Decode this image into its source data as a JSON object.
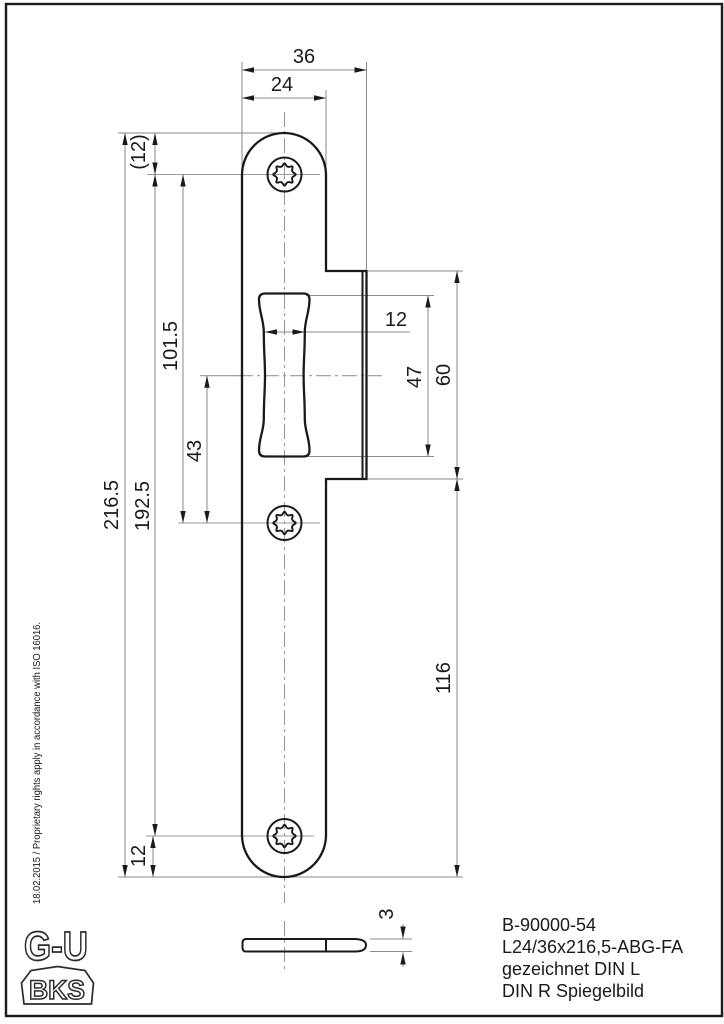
{
  "page": {
    "background": "#ffffff",
    "frame_color": "#1a1a1a"
  },
  "colors": {
    "outline": "#1a1a1a",
    "dimension_line": "#8a8a8a",
    "centerline": "#9a9a9a",
    "text": "#1a1a1a"
  },
  "front_view": {
    "dims": {
      "outer_width": "36",
      "plate_width": "24",
      "total_length": "216.5",
      "hole_spacing": "192.5",
      "top_hole_to_middle_hole": "101.5",
      "slot_center_to_middle_hole": "43",
      "top_hole_offset": "(12)",
      "bottom_hole_offset": "12",
      "slot_width": "12",
      "slot_length": "47",
      "lip_length": "60",
      "lip_to_bottom": "116"
    }
  },
  "side_view": {
    "thickness": "3"
  },
  "title_block": {
    "part_number": "B-90000-54",
    "designation": "L24/36x216,5-ABG-FA",
    "drawn_note": "gezeichnet DIN L",
    "mirror_note": "DIN R Spiegelbild"
  },
  "margin_note": "18.02.2015 / Proprietary rights apply in accordance with ISO 16016.",
  "logos": {
    "gu": "G-U",
    "bks": "BKS"
  }
}
